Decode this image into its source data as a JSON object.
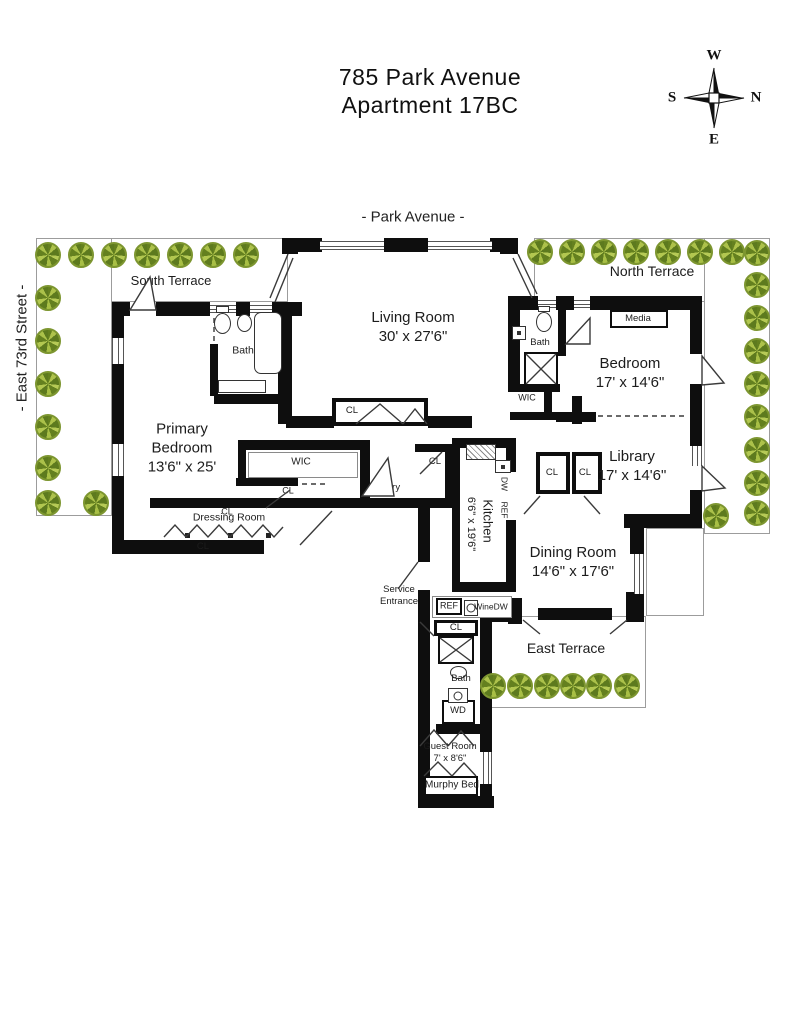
{
  "title": {
    "line1": "785 Park Avenue",
    "line2": "Apartment 17BC"
  },
  "streets": {
    "top": "- Park Avenue -",
    "left": "- East 73rd Street -"
  },
  "compass": {
    "w": "W",
    "n": "N",
    "e": "E",
    "s": "S"
  },
  "colors": {
    "wall": "#0e0e0e",
    "tree_light": "#b6ca56",
    "tree_dark": "#5d7a1e",
    "terrace_line": "#9c9c9c"
  },
  "plan": {
    "terraces": [
      [
        36,
        238,
        252,
        64
      ],
      [
        36,
        238,
        76,
        278
      ],
      [
        534,
        238,
        236,
        64
      ],
      [
        704,
        238,
        66,
        296
      ],
      [
        646,
        528,
        58,
        88
      ],
      [
        490,
        616,
        156,
        92
      ]
    ],
    "walls": [
      [
        282,
        238,
        40,
        14
      ],
      [
        384,
        238,
        44,
        14
      ],
      [
        490,
        238,
        28,
        14
      ],
      [
        500,
        238,
        18,
        16
      ],
      [
        282,
        238,
        16,
        16
      ],
      [
        112,
        302,
        18,
        14
      ],
      [
        156,
        302,
        54,
        14
      ],
      [
        236,
        302,
        14,
        14
      ],
      [
        272,
        302,
        30,
        14
      ],
      [
        112,
        316,
        12,
        22
      ],
      [
        112,
        364,
        12,
        80
      ],
      [
        112,
        476,
        12,
        68
      ],
      [
        112,
        540,
        152,
        14
      ],
      [
        150,
        498,
        186,
        10
      ],
      [
        210,
        344,
        8,
        52
      ],
      [
        214,
        394,
        78,
        10
      ],
      [
        278,
        302,
        14,
        122
      ],
      [
        286,
        416,
        48,
        12
      ],
      [
        428,
        416,
        44,
        12
      ],
      [
        572,
        396,
        10,
        28
      ],
      [
        238,
        440,
        132,
        10
      ],
      [
        238,
        450,
        8,
        34
      ],
      [
        236,
        478,
        62,
        8
      ],
      [
        360,
        440,
        10,
        68
      ],
      [
        334,
        498,
        126,
        10
      ],
      [
        445,
        444,
        10,
        58
      ],
      [
        415,
        444,
        36,
        8
      ],
      [
        452,
        438,
        64,
        10
      ],
      [
        452,
        442,
        8,
        148
      ],
      [
        506,
        442,
        10,
        30
      ],
      [
        506,
        520,
        10,
        70
      ],
      [
        452,
        582,
        64,
        10
      ],
      [
        418,
        498,
        12,
        64
      ],
      [
        418,
        590,
        12,
        212
      ],
      [
        418,
        796,
        76,
        12
      ],
      [
        480,
        614,
        12,
        138
      ],
      [
        480,
        784,
        12,
        24
      ],
      [
        436,
        724,
        56,
        10
      ],
      [
        490,
        610,
        22,
        12
      ],
      [
        508,
        296,
        30,
        14
      ],
      [
        556,
        296,
        18,
        14
      ],
      [
        590,
        296,
        112,
        14
      ],
      [
        508,
        296,
        12,
        96
      ],
      [
        558,
        310,
        8,
        46
      ],
      [
        510,
        384,
        50,
        8
      ],
      [
        510,
        412,
        46,
        8
      ],
      [
        544,
        386,
        8,
        30
      ],
      [
        556,
        412,
        40,
        10
      ],
      [
        690,
        296,
        12,
        58
      ],
      [
        690,
        384,
        12,
        62
      ],
      [
        690,
        490,
        12,
        38
      ],
      [
        624,
        514,
        78,
        14
      ],
      [
        630,
        528,
        14,
        26
      ],
      [
        630,
        594,
        14,
        28
      ],
      [
        508,
        598,
        14,
        26
      ],
      [
        538,
        608,
        74,
        12
      ],
      [
        626,
        592,
        18,
        30
      ]
    ],
    "windows": [
      [
        320,
        241,
        64,
        9,
        "h"
      ],
      [
        428,
        241,
        64,
        9,
        "h"
      ],
      [
        210,
        305,
        26,
        8,
        "h"
      ],
      [
        250,
        305,
        22,
        8,
        "h"
      ],
      [
        538,
        300,
        18,
        8,
        "h"
      ],
      [
        574,
        300,
        16,
        8,
        "h"
      ],
      [
        112,
        338,
        12,
        26,
        "v"
      ],
      [
        112,
        444,
        12,
        32,
        "v"
      ],
      [
        692,
        446,
        10,
        20,
        "v"
      ],
      [
        634,
        554,
        10,
        40,
        "v"
      ],
      [
        483,
        752,
        9,
        32,
        "v"
      ]
    ],
    "boxes": [
      {
        "x": 332,
        "y": 398,
        "w": 96,
        "h": 28,
        "bw": 4,
        "name": "living-room-closet"
      },
      {
        "x": 610,
        "y": 310,
        "w": 58,
        "h": 18,
        "bw": 2,
        "name": "media-cabinet"
      },
      {
        "x": 536,
        "y": 452,
        "w": 34,
        "h": 42,
        "bw": 4,
        "name": "library-closet-1"
      },
      {
        "x": 572,
        "y": 452,
        "w": 30,
        "h": 42,
        "bw": 4,
        "name": "library-closet-2"
      },
      {
        "x": 432,
        "y": 596,
        "w": 80,
        "h": 22,
        "bw": 1,
        "light": true,
        "name": "butler-counter"
      },
      {
        "x": 436,
        "y": 598,
        "w": 26,
        "h": 17,
        "bw": 2,
        "name": "ref-box"
      },
      {
        "x": 434,
        "y": 620,
        "w": 44,
        "h": 16,
        "bw": 3,
        "name": "hall-closet"
      },
      {
        "x": 438,
        "y": 636,
        "w": 36,
        "h": 28,
        "bw": 2,
        "name": "shower-guest"
      },
      {
        "x": 524,
        "y": 352,
        "w": 34,
        "h": 34,
        "bw": 2,
        "name": "shower-bedroom"
      },
      {
        "x": 442,
        "y": 700,
        "w": 33,
        "h": 24,
        "bw": 2,
        "name": "washer-dryer-box"
      },
      {
        "x": 424,
        "y": 776,
        "w": 54,
        "h": 20,
        "bw": 2,
        "name": "murphy-bed-box"
      },
      {
        "x": 248,
        "y": 452,
        "w": 110,
        "h": 26,
        "bw": 1,
        "light": true,
        "name": "wic-shelving"
      }
    ],
    "fixtures": [
      {
        "t": "rrect",
        "x": 254,
        "y": 312,
        "w": 28,
        "h": 62,
        "name": "bathtub"
      },
      {
        "t": "rect",
        "x": 216,
        "y": 306,
        "w": 13,
        "h": 7,
        "name": "toilet-tank"
      },
      {
        "t": "ell",
        "x": 214,
        "y": 313,
        "w": 17,
        "h": 21,
        "name": "toilet"
      },
      {
        "t": "ell",
        "x": 237,
        "y": 314,
        "w": 15,
        "h": 18,
        "name": "sink"
      },
      {
        "t": "rect",
        "x": 218,
        "y": 380,
        "w": 48,
        "h": 13,
        "name": "bench"
      },
      {
        "t": "rect",
        "x": 538,
        "y": 306,
        "w": 12,
        "h": 6,
        "name": "toilet-tank"
      },
      {
        "t": "ell",
        "x": 536,
        "y": 312,
        "w": 16,
        "h": 20,
        "name": "toilet"
      },
      {
        "t": "dot",
        "x": 512,
        "y": 326,
        "w": 14,
        "h": 14,
        "name": "sink"
      },
      {
        "t": "ell",
        "x": 450,
        "y": 666,
        "w": 17,
        "h": 13,
        "name": "toilet"
      },
      {
        "t": "circ",
        "x": 448,
        "y": 688,
        "w": 20,
        "h": 15,
        "name": "sink"
      },
      {
        "t": "hatch",
        "x": 466,
        "y": 444,
        "w": 30,
        "h": 16,
        "name": "stove"
      },
      {
        "t": "dot",
        "x": 495,
        "y": 460,
        "w": 16,
        "h": 13,
        "name": "kitchen-sink"
      },
      {
        "t": "circ",
        "x": 464,
        "y": 600,
        "w": 14,
        "h": 16,
        "name": "wine-cooler"
      },
      {
        "t": "sq",
        "x": 185,
        "y": 533,
        "w": 5,
        "h": 5,
        "name": "rod-dot"
      },
      {
        "t": "sq",
        "x": 228,
        "y": 533,
        "w": 5,
        "h": 5,
        "name": "rod-dot"
      },
      {
        "t": "sq",
        "x": 266,
        "y": 533,
        "w": 5,
        "h": 5,
        "name": "rod-dot"
      }
    ],
    "paths": [
      {
        "d": "M288,254 L270,298",
        "name": "corner-window"
      },
      {
        "d": "M293,258 L275,302",
        "name": "corner-window"
      },
      {
        "d": "M518,254 L537,294",
        "name": "corner-window"
      },
      {
        "d": "M513,258 L532,298",
        "name": "corner-window"
      },
      {
        "d": "M130,310 L150,277 L156,310 Z",
        "f": "#fff",
        "name": "door-swing-terrace"
      },
      {
        "d": "M362,496 L388,458 L394,496 Z",
        "f": "#fff",
        "name": "door-swing-entry"
      },
      {
        "d": "M702,356 L724,383 L702,385 Z",
        "f": "#fff",
        "name": "door-swing-bedroom-terrace"
      },
      {
        "d": "M702,466 L725,488 L702,491 Z",
        "f": "#fff",
        "name": "door-swing-library-terrace"
      },
      {
        "d": "M566,344 L590,318 L590,344 Z",
        "f": "#fff",
        "name": "door-swing-bath"
      },
      {
        "d": "M523,620 L540,634",
        "name": "door-dining"
      },
      {
        "d": "M627,620 L610,634",
        "name": "door-dining"
      },
      {
        "d": "M418,562 L398,589",
        "name": "door-service"
      },
      {
        "d": "M356,424 L380,404 L403,424 M403,424 L415,409 L427,424",
        "name": "bifold-doors"
      },
      {
        "d": "M164,537 L175,525 L186,537 L197,525 L208,537 L219,525 L230,537 L241,525 L252,537 L263,525 L274,537 L283,527",
        "name": "closet-rod"
      },
      {
        "d": "M300,545 L332,511",
        "name": "door-dressing"
      },
      {
        "d": "M266,508 L290,490",
        "name": "door-closet"
      },
      {
        "d": "M540,496 L524,514",
        "name": "door-closet"
      },
      {
        "d": "M584,496 L600,514",
        "name": "door-closet"
      },
      {
        "d": "M420,474 L442,452",
        "name": "door-closet"
      },
      {
        "d": "M434,636 L420,622",
        "name": "door-closet"
      },
      {
        "d": "M526,354 L556,384 M556,354 L526,384",
        "name": "shower-x"
      },
      {
        "d": "M440,638 L472,662 M472,638 L440,662",
        "name": "shower-x"
      },
      {
        "d": "M598,416 L686,416",
        "dash": 1,
        "name": "door-open"
      },
      {
        "d": "M302,484 L328,484",
        "dash": 1,
        "name": "door-open"
      },
      {
        "d": "M214,318 L214,342",
        "dash": 1,
        "name": "door-open"
      },
      {
        "d": "M420,746 L434,730 L448,746 M448,746 L461,731 L474,746",
        "name": "guest-doors"
      },
      {
        "d": "M424,776 L438,762 L452,776 M452,776 L464,763 L476,776",
        "name": "murphy-doors"
      }
    ],
    "trees": [
      [
        48,
        255
      ],
      [
        81,
        255
      ],
      [
        114,
        255
      ],
      [
        147,
        255
      ],
      [
        180,
        255
      ],
      [
        213,
        255
      ],
      [
        246,
        255
      ],
      [
        48,
        298
      ],
      [
        48,
        341
      ],
      [
        48,
        384
      ],
      [
        48,
        427
      ],
      [
        48,
        468
      ],
      [
        48,
        503
      ],
      [
        96,
        503
      ],
      [
        540,
        252
      ],
      [
        572,
        252
      ],
      [
        604,
        252
      ],
      [
        636,
        252
      ],
      [
        668,
        252
      ],
      [
        700,
        252
      ],
      [
        732,
        252
      ],
      [
        757,
        253
      ],
      [
        757,
        285
      ],
      [
        757,
        318
      ],
      [
        757,
        351
      ],
      [
        757,
        384
      ],
      [
        757,
        417
      ],
      [
        757,
        450
      ],
      [
        757,
        483
      ],
      [
        757,
        513
      ],
      [
        716,
        516
      ],
      [
        493,
        686
      ],
      [
        520,
        686
      ],
      [
        547,
        686
      ],
      [
        573,
        686
      ],
      [
        599,
        686
      ],
      [
        627,
        686
      ]
    ],
    "labels": [
      {
        "name": "label-south-terrace",
        "t": "South Terrace",
        "x": 171,
        "y": 281,
        "s": 13
      },
      {
        "name": "label-north-terrace",
        "t": "North Terrace",
        "x": 652,
        "y": 272,
        "s": 14
      },
      {
        "name": "label-east-terrace",
        "t": "East Terrace",
        "x": 566,
        "y": 649,
        "s": 14
      },
      {
        "name": "label-living-room",
        "lines": [
          "Living Room",
          "30' x 27'6\""
        ],
        "x": 413,
        "y": 327,
        "s": 15
      },
      {
        "name": "label-primary-bedroom",
        "lines": [
          "Primary",
          "Bedroom",
          "13'6\" x 25'"
        ],
        "x": 182,
        "y": 448,
        "s": 15
      },
      {
        "name": "label-bedroom",
        "lines": [
          "Bedroom",
          "17' x 14'6\""
        ],
        "x": 630,
        "y": 373,
        "s": 15
      },
      {
        "name": "label-library",
        "lines": [
          "Library",
          "17' x 14'6\""
        ],
        "x": 632,
        "y": 466,
        "s": 15
      },
      {
        "name": "label-dining-room",
        "lines": [
          "Dining Room",
          "14'6\" x 17'6\""
        ],
        "x": 573,
        "y": 562,
        "s": 15
      },
      {
        "name": "label-kitchen",
        "t": "Kitchen",
        "x": 487,
        "y": 521,
        "s": 13,
        "r": 90
      },
      {
        "name": "label-kitchen-dims",
        "t": "6'6\" x 19'6\"",
        "x": 470,
        "y": 524,
        "s": 11,
        "r": 90
      },
      {
        "name": "label-guest-room",
        "lines": [
          "Guest Room",
          "7' x 8'6\""
        ],
        "x": 450,
        "y": 753,
        "s": 9.5
      },
      {
        "name": "label-murphy-bed",
        "t": "Murphy Bed",
        "x": 452,
        "y": 786,
        "s": 10
      },
      {
        "name": "label-bath-primary",
        "t": "Bath",
        "x": 243,
        "y": 351,
        "s": 10.5
      },
      {
        "name": "label-bath-bedroom",
        "t": "Bath",
        "x": 540,
        "y": 343,
        "s": 9.5
      },
      {
        "name": "label-bath-guest",
        "t": "Bath",
        "x": 461,
        "y": 679,
        "s": 9.5
      },
      {
        "name": "label-wic-primary",
        "t": "WIC",
        "x": 301,
        "y": 463,
        "s": 10
      },
      {
        "name": "label-wic-bedroom",
        "t": "WIC",
        "x": 527,
        "y": 398,
        "s": 9
      },
      {
        "name": "label-media",
        "t": "Media",
        "x": 638,
        "y": 319,
        "s": 9.5
      },
      {
        "name": "label-entry",
        "t": "Entry",
        "x": 389,
        "y": 488,
        "s": 9.5
      },
      {
        "name": "label-dressing-room",
        "t": "Dressing Room",
        "x": 229,
        "y": 518,
        "s": 10.5
      },
      {
        "name": "label-cl-living",
        "t": "CL",
        "x": 352,
        "y": 411,
        "s": 9.5
      },
      {
        "name": "label-cl-entry",
        "t": "CL",
        "x": 435,
        "y": 462,
        "s": 9.5
      },
      {
        "name": "label-cl-library-1",
        "t": "CL",
        "x": 552,
        "y": 473,
        "s": 9.5
      },
      {
        "name": "label-cl-library-2",
        "t": "CL",
        "x": 585,
        "y": 473,
        "s": 9.5
      },
      {
        "name": "label-cl-wic",
        "t": "CL",
        "x": 288,
        "y": 491,
        "s": 9
      },
      {
        "name": "label-cl-dressing-top",
        "t": "CL",
        "x": 227,
        "y": 512,
        "s": 9
      },
      {
        "name": "label-cl-dressing",
        "t": "CL",
        "x": 203,
        "y": 547,
        "s": 9.5
      },
      {
        "name": "label-cl-hall",
        "t": "CL",
        "x": 456,
        "y": 628,
        "s": 9.5
      },
      {
        "name": "label-ref",
        "t": "REF",
        "x": 449,
        "y": 606,
        "s": 9
      },
      {
        "name": "label-winedw",
        "t": "WineDW",
        "x": 491,
        "y": 607,
        "s": 8.5
      },
      {
        "name": "label-dw",
        "t": "DW",
        "x": 504,
        "y": 484,
        "s": 8.5,
        "r": 90
      },
      {
        "name": "label-ref-kitchen",
        "t": "REF",
        "x": 504,
        "y": 510,
        "s": 8.5,
        "r": 90
      },
      {
        "name": "label-wd",
        "t": "WD",
        "x": 458,
        "y": 711,
        "s": 9.5
      },
      {
        "name": "label-service-entrance",
        "lines": [
          "Service",
          "Entrance"
        ],
        "x": 399,
        "y": 596,
        "s": 9.5
      }
    ]
  }
}
